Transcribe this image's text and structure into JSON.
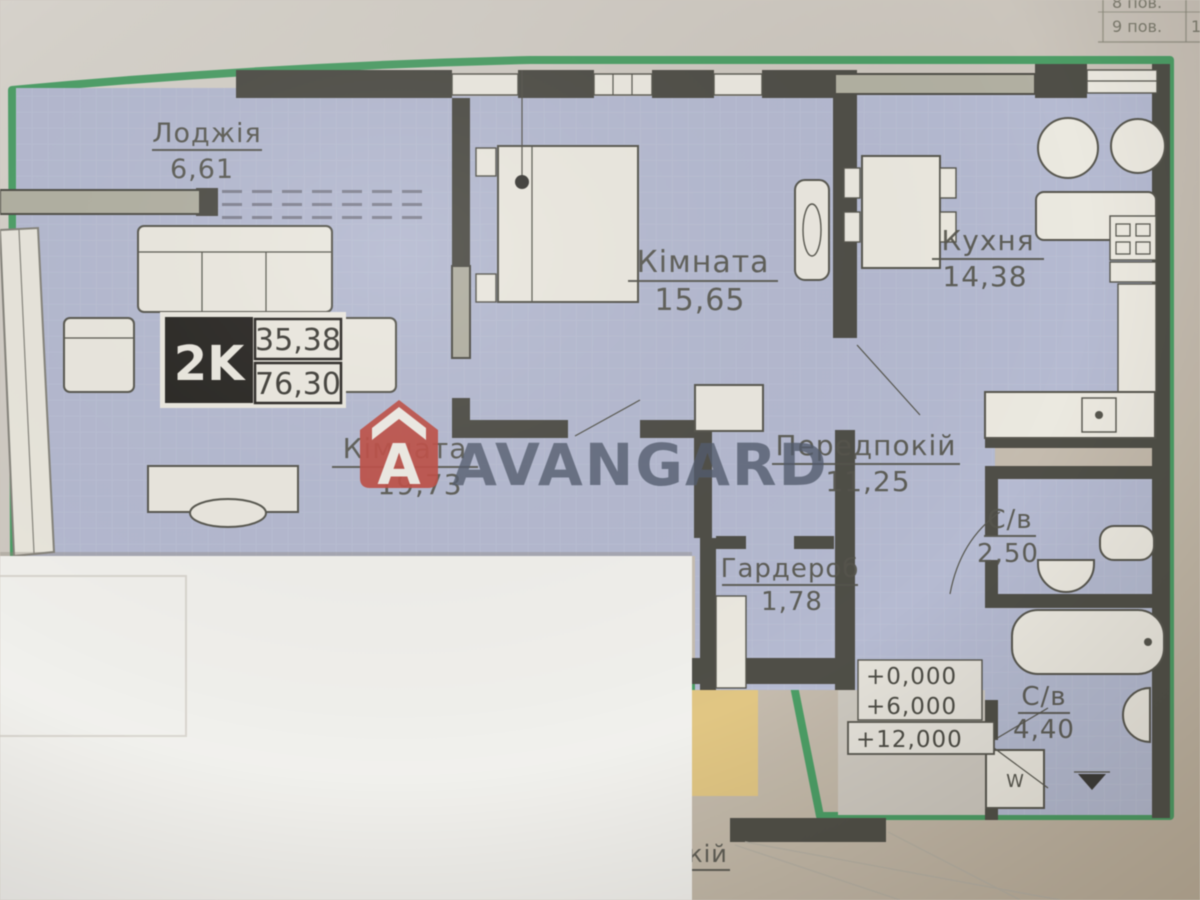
{
  "palette": {
    "paper_light": "#d9d4cc",
    "paper": "#cdc6bc",
    "paper_dark": "#c2b5a1",
    "room_fill": "#b6bcd5",
    "wall_dark": "#4e4d45",
    "wall_light": "#b4b2a2",
    "green_border": "#3f9e5e",
    "fixture_white": "#efece2",
    "yellow_area": "#e6c87e",
    "watermark_text_color": "#505a6e",
    "watermark_logo_red": "#c84a40",
    "badge_black": "#26231f",
    "label_ink": "#55544b"
  },
  "unit_badge": {
    "type_label": "2K",
    "area_living": "35,38",
    "area_total": "76,30"
  },
  "rooms": [
    {
      "name": "Лоджія",
      "area": "6,61"
    },
    {
      "name": "Кімната",
      "area": "15,65"
    },
    {
      "name": "Кухня",
      "area": "14,38"
    },
    {
      "name": "Кімната",
      "area": "19,73"
    },
    {
      "name": "Передпокій",
      "area": "11,25"
    },
    {
      "name": "Гардероб",
      "area": "1,78"
    },
    {
      "name": "С/в",
      "area": "2,50"
    },
    {
      "name": "С/в",
      "area": "4,40"
    }
  ],
  "elevation_marks": {
    "m0": "+0,000",
    "m1": "+6,000",
    "m2": "+12,000"
  },
  "corner_table": {
    "row1": "8 пов.",
    "row2": "9 пов.",
    "row2_right": "1"
  },
  "watermark": {
    "text": "AVANGARD",
    "logo_letter": "A"
  },
  "partial_label": "кій",
  "washing_machine_label": "W"
}
